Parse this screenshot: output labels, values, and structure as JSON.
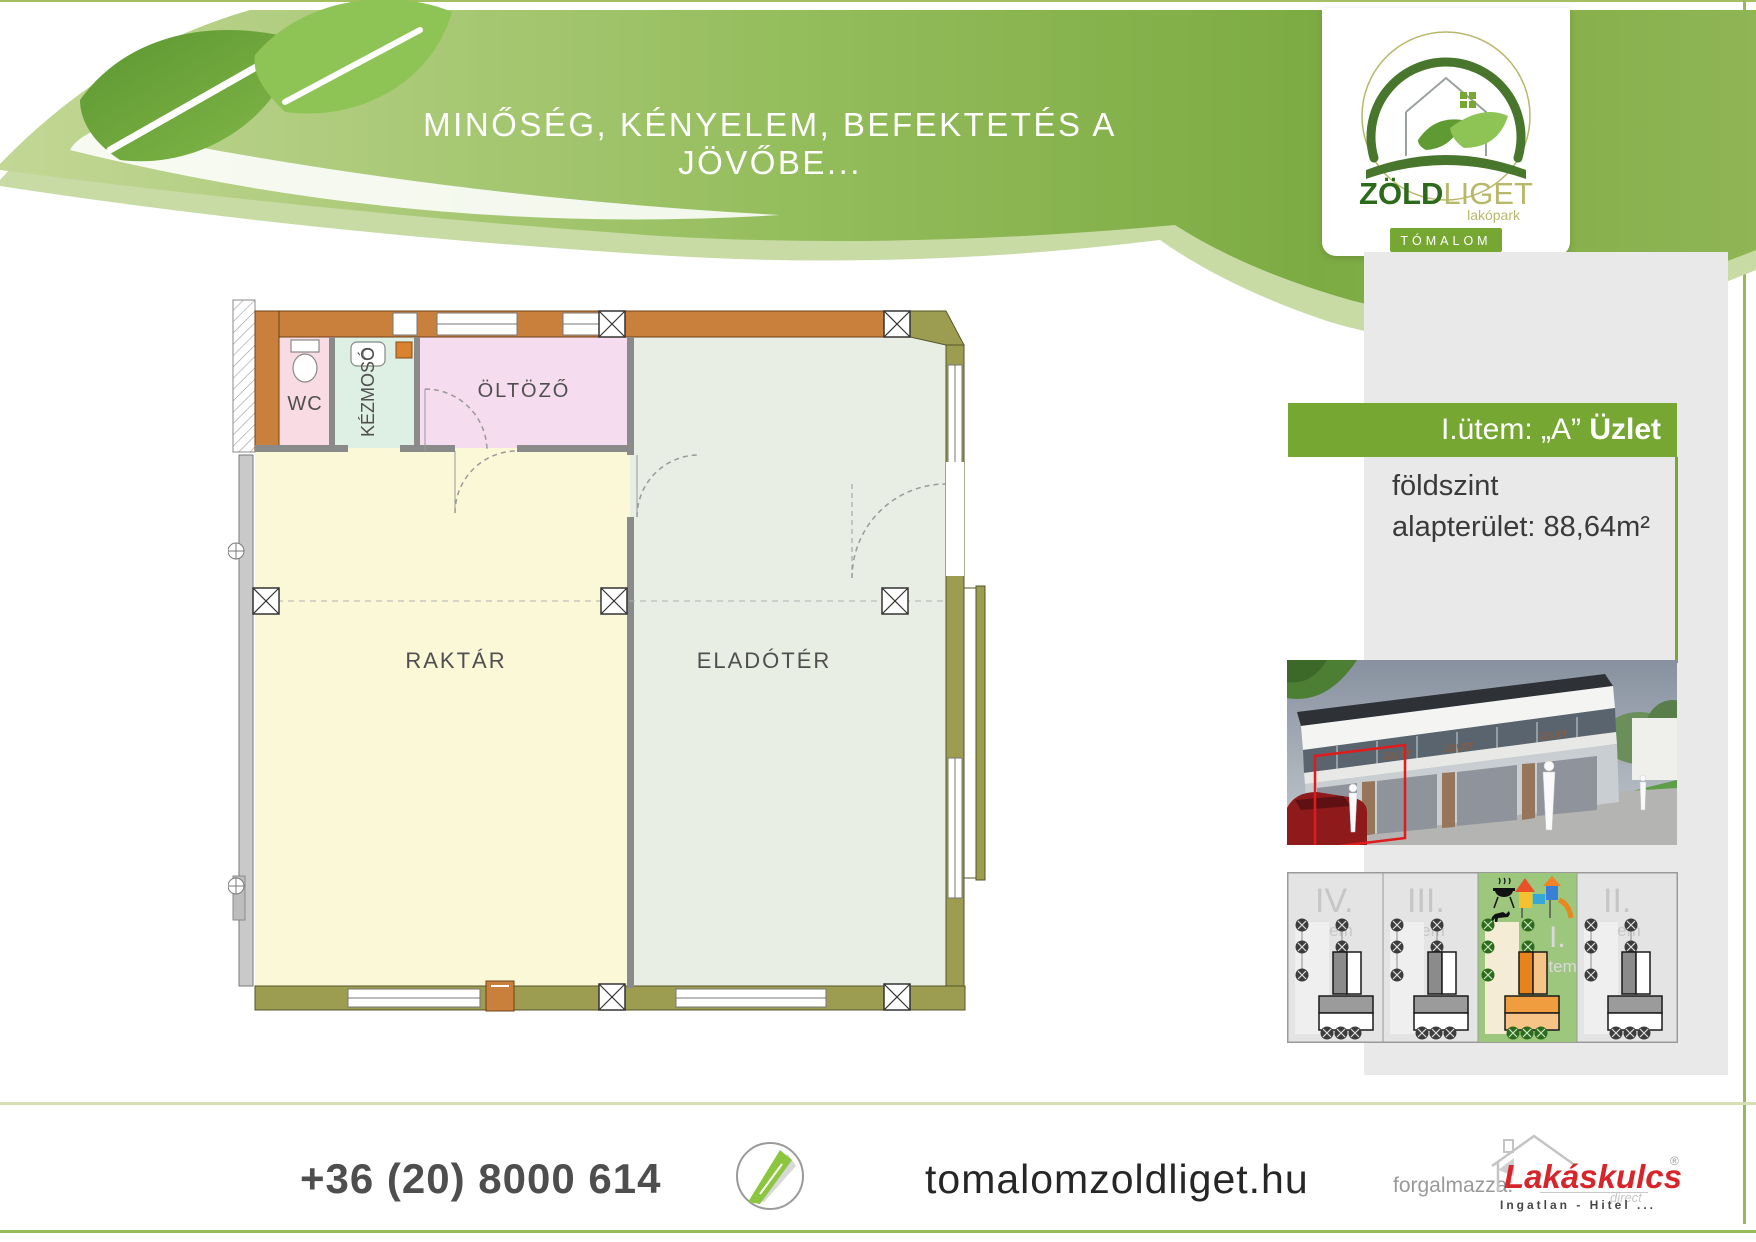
{
  "header": {
    "slogan": "MINŐSÉG, KÉNYELEM, BEFEKTETÉS A JÖVŐBE...",
    "logo": {
      "title_bold": "ZÖLD",
      "title_light": "LIGET",
      "subtitle": "lakópark",
      "badge": "TÓMALOM"
    }
  },
  "info_panel": {
    "banner_regular": "I.ütem: „A” ",
    "banner_bold": "Üzlet",
    "floor": "földszint",
    "area": "alapterület: 88,64m²"
  },
  "floor_plan": {
    "rooms": [
      {
        "label": "WC"
      },
      {
        "label": "KÉZMOSÓ"
      },
      {
        "label": "ÖLTÖZŐ"
      },
      {
        "label": "RAKTÁR"
      },
      {
        "label": "ELADÓTÉR"
      }
    ]
  },
  "building_render": {
    "signs": [
      "ÜZLET",
      "ÜZLET",
      "ÜZLET"
    ]
  },
  "site_plan": {
    "sections": [
      {
        "numeral": "IV.",
        "word": "ütem",
        "highlighted": false
      },
      {
        "numeral": "III.",
        "word": "ütem",
        "highlighted": false
      },
      {
        "numeral": "I.",
        "word": "ütem",
        "highlighted": true
      },
      {
        "numeral": "II.",
        "word": "ütem",
        "highlighted": false
      }
    ]
  },
  "footer": {
    "phone": "+36 (20) 8000 614",
    "website": "tomalomzoldliget.hu",
    "distributor_label": "forgalmazza:",
    "brand": "Lakáskulcs",
    "brand_mark": "®",
    "brand_sub": "direct",
    "brand_tagline": "Ingatlan - Hitel ..."
  },
  "colors": {
    "accent_green": "#76a733",
    "wave_green": "#8fbb55",
    "band_gray": "#e9e9e9",
    "wall_orange": "#c9803d",
    "wall_olive": "#9d9d52",
    "brand_red": "#d6252b",
    "highlight_site": "#9cc77d"
  }
}
